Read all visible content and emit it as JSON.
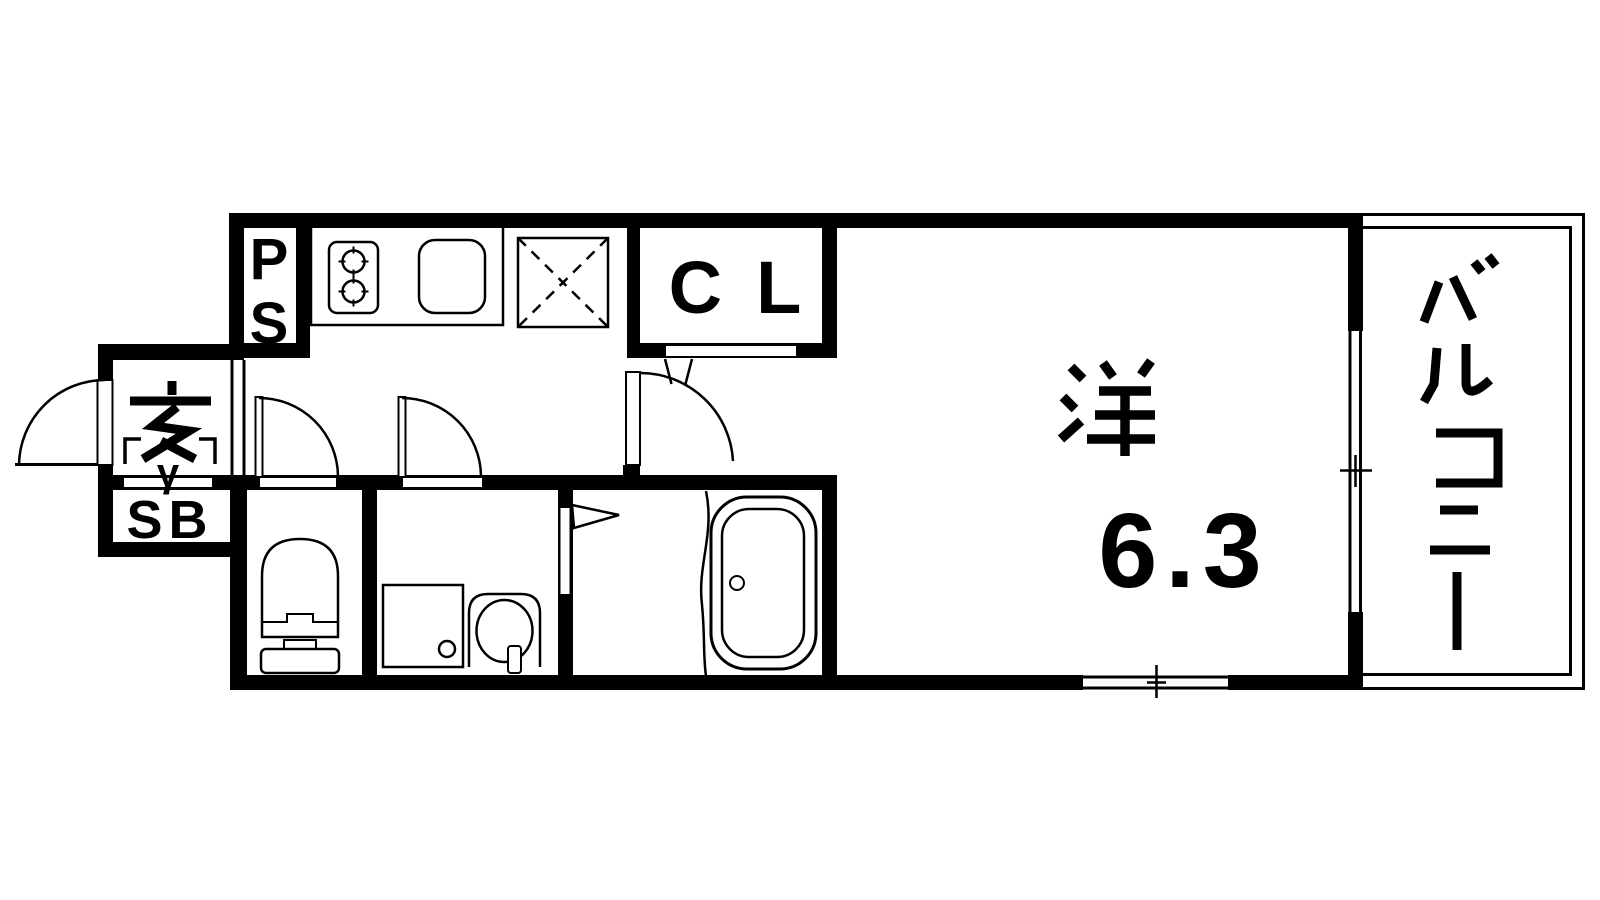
{
  "plan": {
    "labels": {
      "pipe_space": {
        "name": "PS",
        "chars": [
          "P",
          "S"
        ]
      },
      "closet": {
        "name": "CL"
      },
      "entrance": {
        "name": "玄",
        "step_mark": "γ"
      },
      "shoe_box": {
        "name": "SB"
      },
      "western_room": {
        "name": "洋",
        "size": "6.3"
      },
      "balcony": {
        "name": "バルコニー",
        "chars": [
          "バ",
          "ル",
          "コ",
          "ニ",
          "ー"
        ]
      }
    },
    "fixtures": {
      "stove": "2-burner gas stove",
      "kitchen_sink": "kitchen sink",
      "refrigerator_space": "refrigerator space (dashed X)",
      "toilet": "toilet",
      "washing_machine_pan": "washing machine pan",
      "washbasin": "washbasin",
      "bathtub": "bathtub",
      "entrance_door": "entrance swing door",
      "toilet_door": "toilet swing door",
      "washroom_door": "washroom swing door",
      "room_door": "main room swing door",
      "closet_door": "closet sliding door",
      "bathroom_door": "bathroom folding door",
      "balcony_window": "sliding window to balcony",
      "rear_window": "sliding window in bottom wall"
    },
    "colors": {
      "wall": "#000000",
      "background": "#ffffff"
    }
  }
}
